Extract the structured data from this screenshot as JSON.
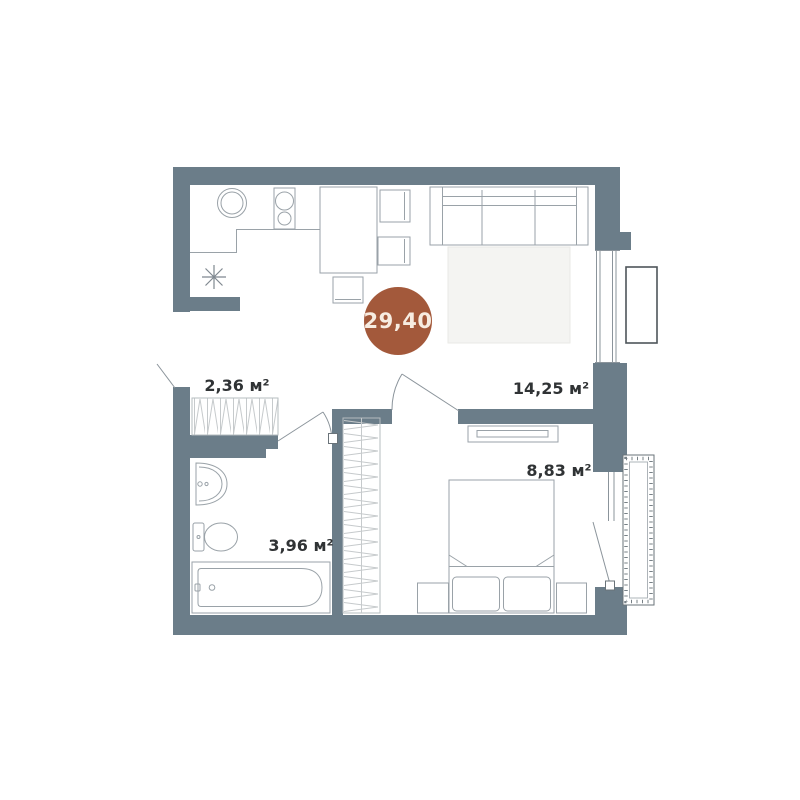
{
  "plan": {
    "type": "apartment-floor-plan",
    "total_area_label": "29,40",
    "rooms": [
      {
        "name": "hallway",
        "area_label": "2,36 м²"
      },
      {
        "name": "kitchen-living-room",
        "area_label": "14,25 м²"
      },
      {
        "name": "bathroom",
        "area_label": "3,96 м²"
      },
      {
        "name": "bedroom",
        "area_label": "8,83 м²"
      }
    ],
    "symbols": [
      "kitchen-sink",
      "stove",
      "fridge-star",
      "dining-table",
      "chair",
      "sofa",
      "rug",
      "tv-console",
      "double-bed",
      "pillows",
      "nightstand",
      "wardrobe-hangers",
      "wash-basin",
      "toilet",
      "bathtub",
      "window",
      "french-balcony",
      "balcony",
      "door-swing"
    ],
    "colors": {
      "wall": "#6b7d89",
      "badge": "#a3593b",
      "badge_text": "#f7ece1",
      "label_text": "#303335",
      "furniture_line": "#9aa2a8",
      "hatch_line": "#c6cacc",
      "glass_line": "#8b949b",
      "balcony_line": "#6a7379",
      "french_balcony_line": "#4e555a",
      "rug_fill": "#f4f4f2"
    }
  }
}
